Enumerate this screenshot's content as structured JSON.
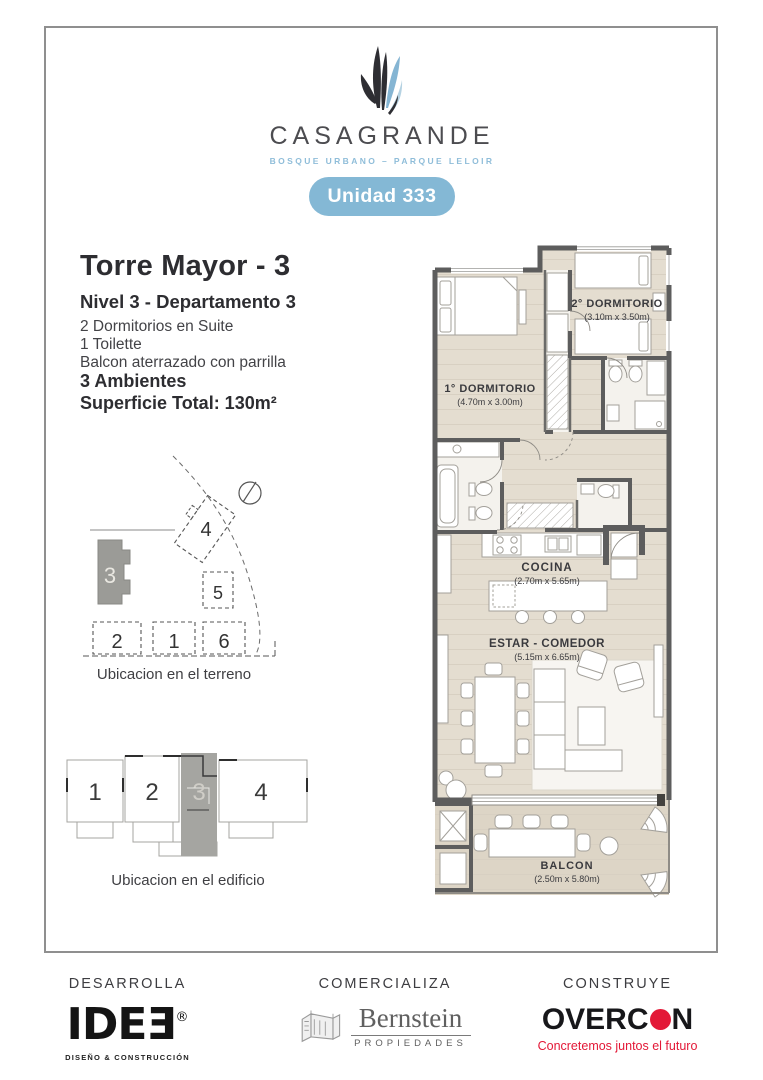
{
  "page": {
    "background": "#ffffff",
    "frame_border": "#8f8f8f"
  },
  "header": {
    "brand": "CASAGRANDE",
    "tagline": "BOSQUE URBANO – PARQUE LELOIR",
    "tagline_color": "#8fbdd9",
    "unit_badge": "Unidad 333",
    "badge_color": "#84b8d5"
  },
  "details": {
    "title": "Torre Mayor - 3",
    "subtitle": "Nivel 3 - Departamento 3",
    "features": [
      "2 Dormitorios en Suite",
      "1 Toilette",
      "Balcon aterrazado con parrilla"
    ],
    "rooms_count": "3 Ambientes",
    "total_area": "Superficie Total: 130m²"
  },
  "floor_plan": {
    "wall_color": "#5d5d5d",
    "floor_color": "#e4ddd0",
    "balcony_floor_color": "#ddd5c6",
    "rooms": [
      {
        "name": "1° DORMITORIO",
        "dims": "(4.70m x 3.00m)"
      },
      {
        "name": "2° DORMITORIO",
        "dims": "(3.10m x 3.50m)"
      },
      {
        "name": "COCINA",
        "dims": "(2.70m x 5.65m)"
      },
      {
        "name": "ESTAR - COMEDOR",
        "dims": "(5.15m x 6.65m)"
      },
      {
        "name": "BALCON",
        "dims": "(2.50m x 5.80m)"
      }
    ]
  },
  "site_plan": {
    "caption": "Ubicacion en el terreno",
    "highlighted": "3",
    "labels": {
      "b1": "1",
      "b2": "2",
      "b3": "3",
      "b4": "4",
      "b5": "5",
      "b6": "6"
    }
  },
  "building_plan": {
    "caption": "Ubicacion en el edificio",
    "highlighted": "3",
    "labels": {
      "u1": "1",
      "u2": "2",
      "u3": "3",
      "u4": "4"
    }
  },
  "footer": {
    "desarrolla": {
      "label": "DESARROLLA",
      "logo": "IDEƎ",
      "registered": "®",
      "tagline": "DISEÑO & CONSTRUCCIÓN"
    },
    "comercializa": {
      "label": "COMERCIALIZA",
      "logo": "Bernstein",
      "tagline": "PROPIEDADES"
    },
    "construye": {
      "label": "CONSTRUYE",
      "logo_prefix": "OVERC",
      "logo_suffix": "N",
      "tagline": "Concretemos juntos el futuro",
      "accent": "#e31837"
    }
  }
}
